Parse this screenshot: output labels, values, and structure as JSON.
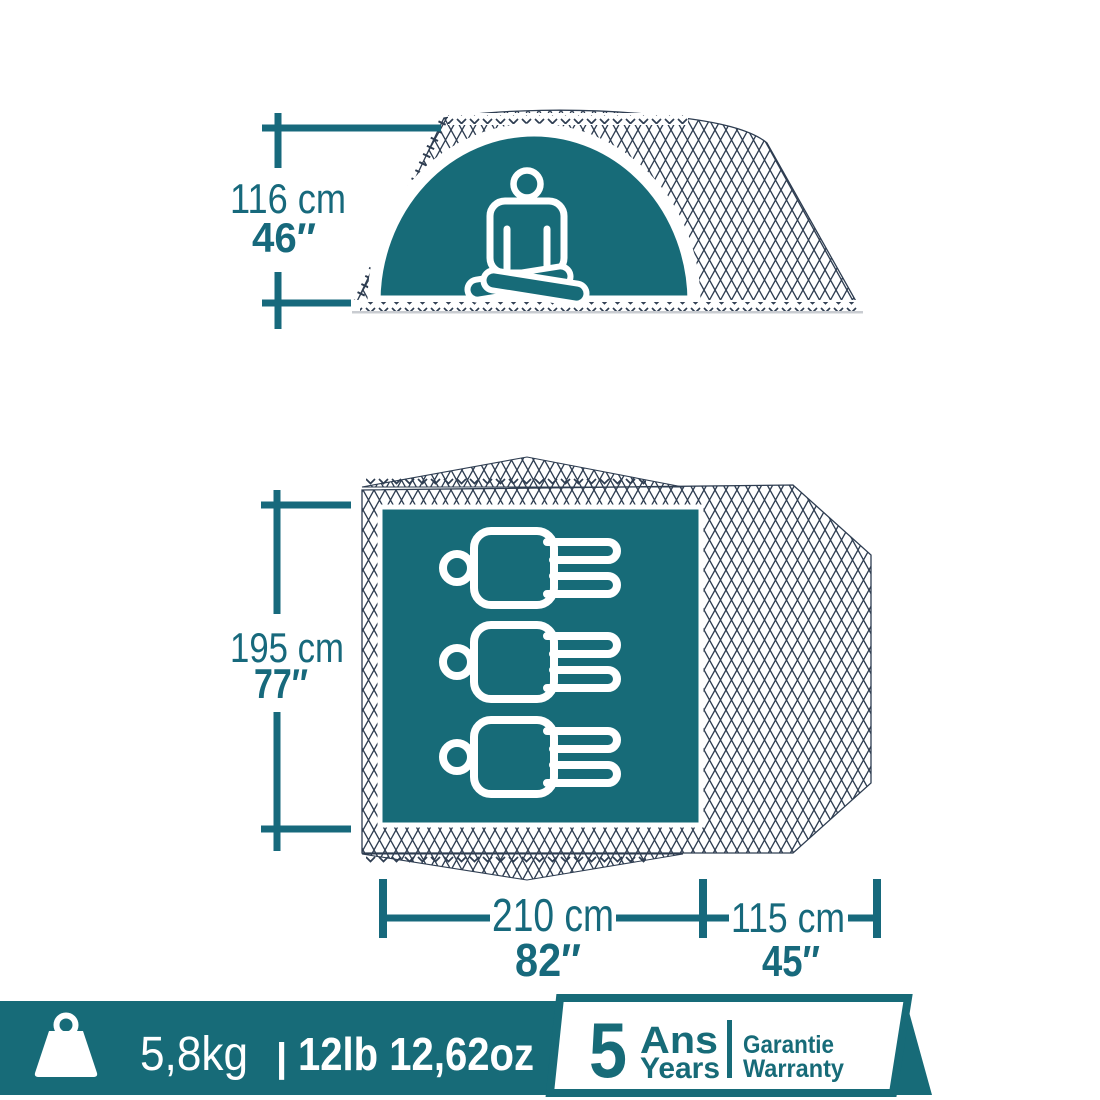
{
  "colors": {
    "teal_fill": "#176b78",
    "mesh_navy": "#2e3d51",
    "dim_text_teal": "#17697c",
    "white": "#ffffff",
    "ground_gray": "#c9ccd1"
  },
  "side_view": {
    "description": "tent side profile with meditating person",
    "height_metric": "116 cm",
    "height_imperial": "46″"
  },
  "top_view": {
    "description": "tent floor plan with 3 sleeping persons",
    "capacity": 3,
    "depth_metric": "195 cm",
    "depth_imperial": "77″",
    "length_metric": "210 cm",
    "length_imperial": "82″",
    "porch_metric": "115 cm",
    "porch_imperial": "45″"
  },
  "banner": {
    "weight_metric": "5,8kg",
    "separator": "|",
    "weight_imperial": "12lb 12,62oz",
    "warranty_number": "5",
    "warranty_unit_fr": "Ans",
    "warranty_unit_en": "Years",
    "warranty_label_fr": "Garantie",
    "warranty_label_en": "Warranty"
  }
}
